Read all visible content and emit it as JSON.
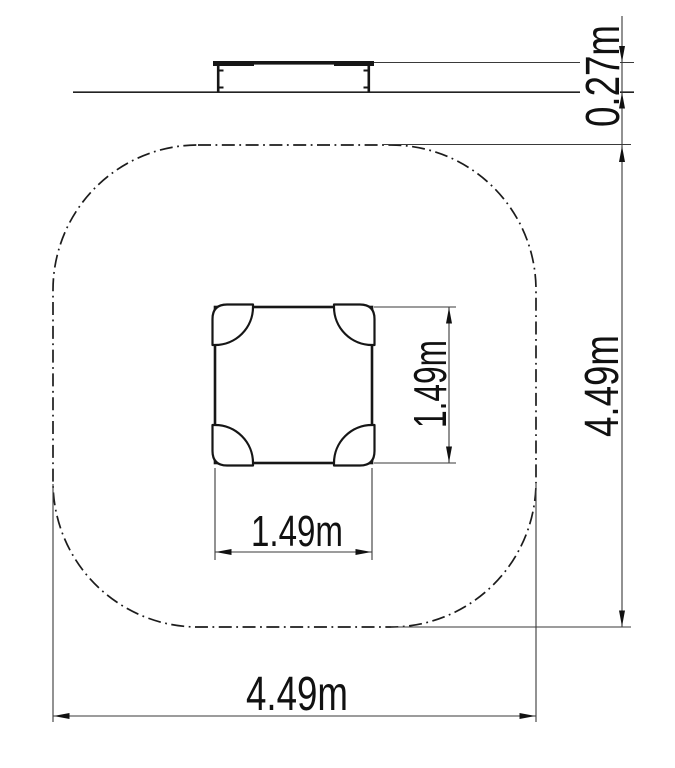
{
  "drawing": {
    "background": "#ffffff",
    "line_color": "#161616",
    "thin_line_color": "#3a3a3a",
    "text_color": "#111111",
    "views": {
      "side_elevation": {
        "dimensions": {
          "platform_height": "0.27m"
        }
      },
      "plan_view": {
        "dimensions": {
          "unit_depth": "1.49m",
          "unit_width": "1.49m",
          "safety_area_depth": "4.49m",
          "safety_area_width": "4.49m"
        }
      }
    }
  }
}
